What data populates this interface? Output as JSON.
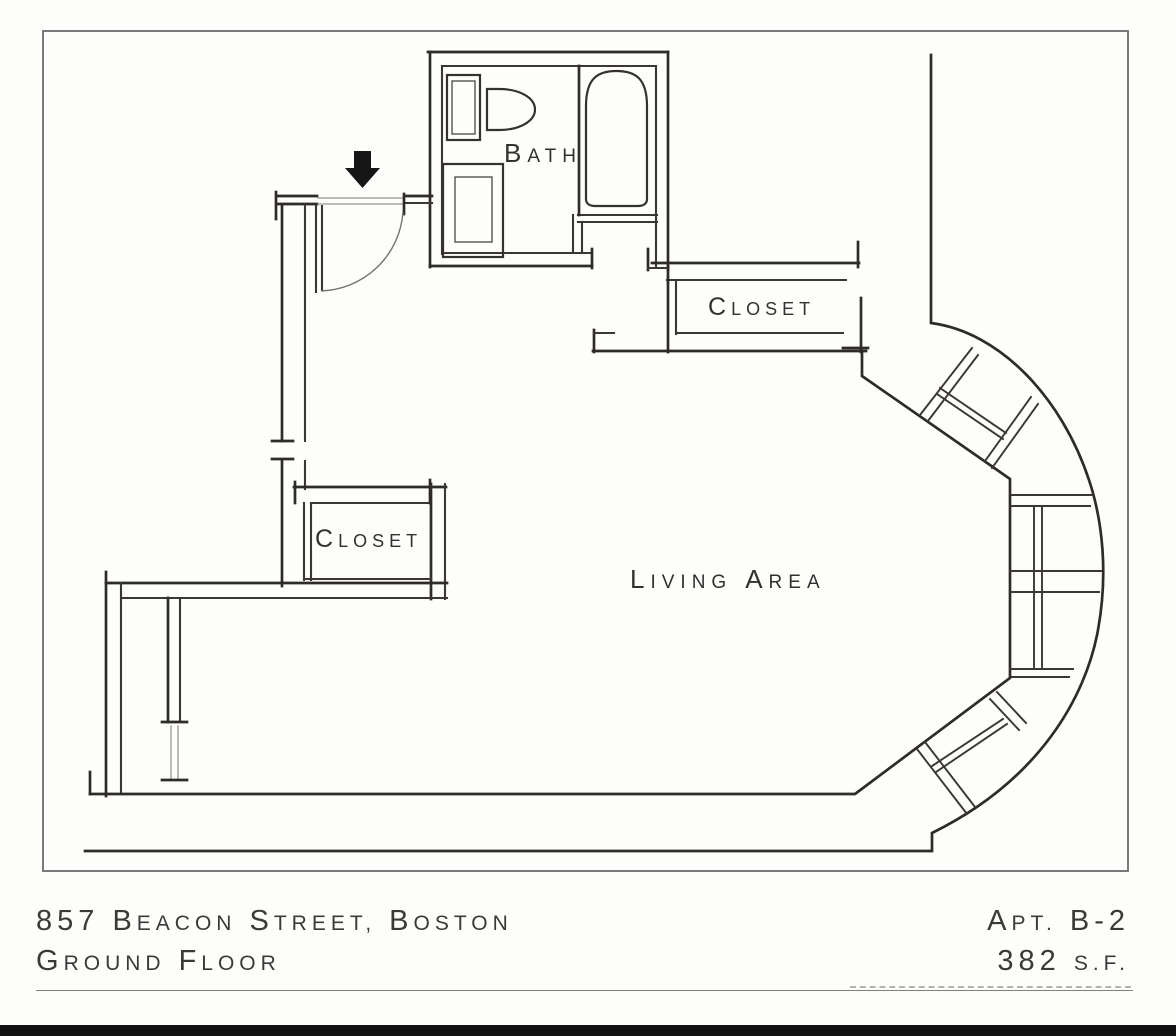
{
  "title": "Floor plan sheet",
  "colors": {
    "paper": "#fdfdfc",
    "ink": "#2e2b28",
    "frame_gray": "#6b6b6b",
    "footer_bar_black": "#121212",
    "entry_arrow_black": "#161616"
  },
  "labels": {
    "bath": [
      {
        "t": "B"
      },
      {
        "t": "ATH"
      }
    ],
    "closet_upper": [
      {
        "t": "C"
      },
      {
        "t": "LOSET"
      }
    ],
    "closet_lower": [
      {
        "t": "C"
      },
      {
        "t": "LOSET"
      }
    ],
    "living_area": [
      {
        "t": "L"
      },
      {
        "t": "IVING"
      },
      {
        "t": "A"
      },
      {
        "t": "REA"
      }
    ]
  },
  "icons": {
    "entry_arrow": "down-arrow-entry-marker"
  },
  "footer": {
    "address": [
      {
        "t": "857 B"
      },
      {
        "t": "EACON"
      },
      {
        "t": "S"
      },
      {
        "t": "TREET,"
      },
      {
        "t": "B"
      },
      {
        "t": "OSTON"
      }
    ],
    "floor": [
      {
        "t": "G"
      },
      {
        "t": "ROUND"
      },
      {
        "t": "F"
      },
      {
        "t": "LOOR"
      }
    ],
    "apt": [
      {
        "t": "A"
      },
      {
        "t": "PT."
      },
      {
        "t": "B-2"
      }
    ],
    "area": [
      {
        "t": "382"
      },
      {
        "t": "S.F."
      }
    ]
  }
}
